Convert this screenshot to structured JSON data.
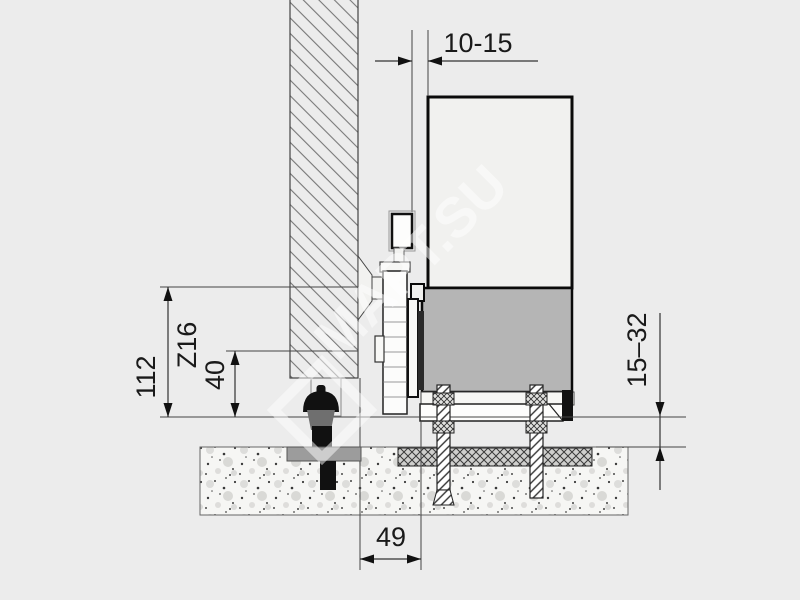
{
  "drawing": {
    "title": "sliding-gate-side-mount-cross-section",
    "dimensions": {
      "gap_top": "10-15",
      "height_total": "112",
      "bracket_code": "Z16",
      "height_small": "40",
      "clearance_right": "15–32",
      "offset_bottom": "49"
    },
    "watermark": {
      "text": "МАРТ.SU",
      "logo": "diamond-outline"
    },
    "colors": {
      "background": "#ececec",
      "gate_panel": "#f1f1ef",
      "guide_rail_gray": "#b5b5b5",
      "steel_black": "#111111",
      "plate_gray": "#9c9c9c",
      "line": "#3a3a3a"
    }
  }
}
